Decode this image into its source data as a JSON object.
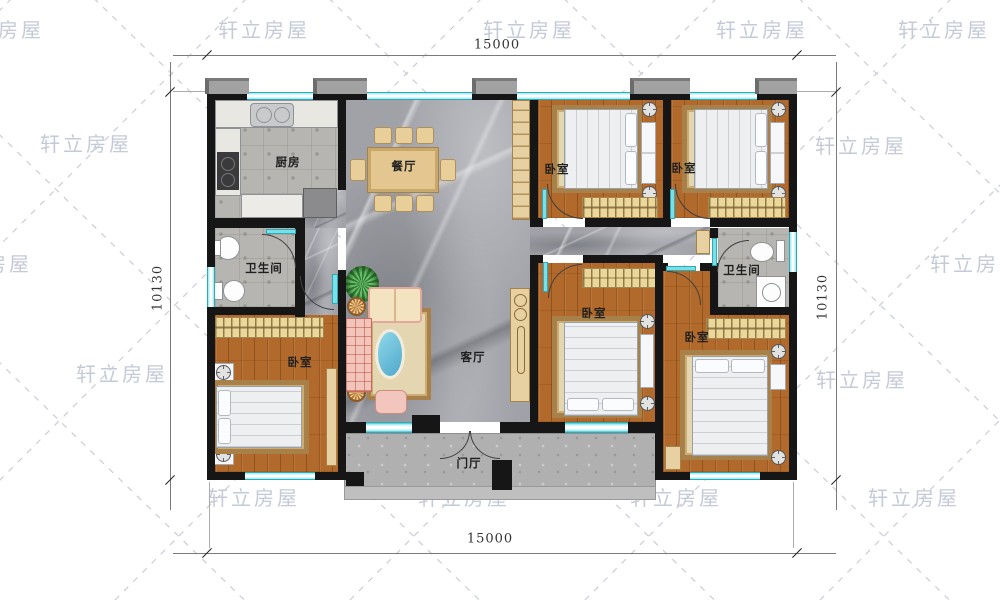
{
  "watermark": {
    "text": "轩立房屋"
  },
  "dimensions": {
    "top": "15000",
    "bottom": "15000",
    "left": "10130",
    "right": "10130"
  },
  "rooms": {
    "kitchen": "厨房",
    "dining": "餐厅",
    "living": "客厅",
    "foyer": "门厅",
    "bath_left": "卫生间",
    "bath_right": "卫生间",
    "bedroom_top_left": "卧室",
    "bedroom_top_right": "卧室",
    "bedroom_left": "卧室",
    "bedroom_center": "卧室",
    "bedroom_right": "卧室"
  },
  "colors": {
    "wall": "#161616",
    "window": "#7ae0e8",
    "wood_floor": "#b16a2b",
    "marble_floor": "#a0a2a8",
    "tile_floor": "#b7b5b1",
    "cabinet_wood": "#ecd79b",
    "watermark": "#c5cad8"
  }
}
